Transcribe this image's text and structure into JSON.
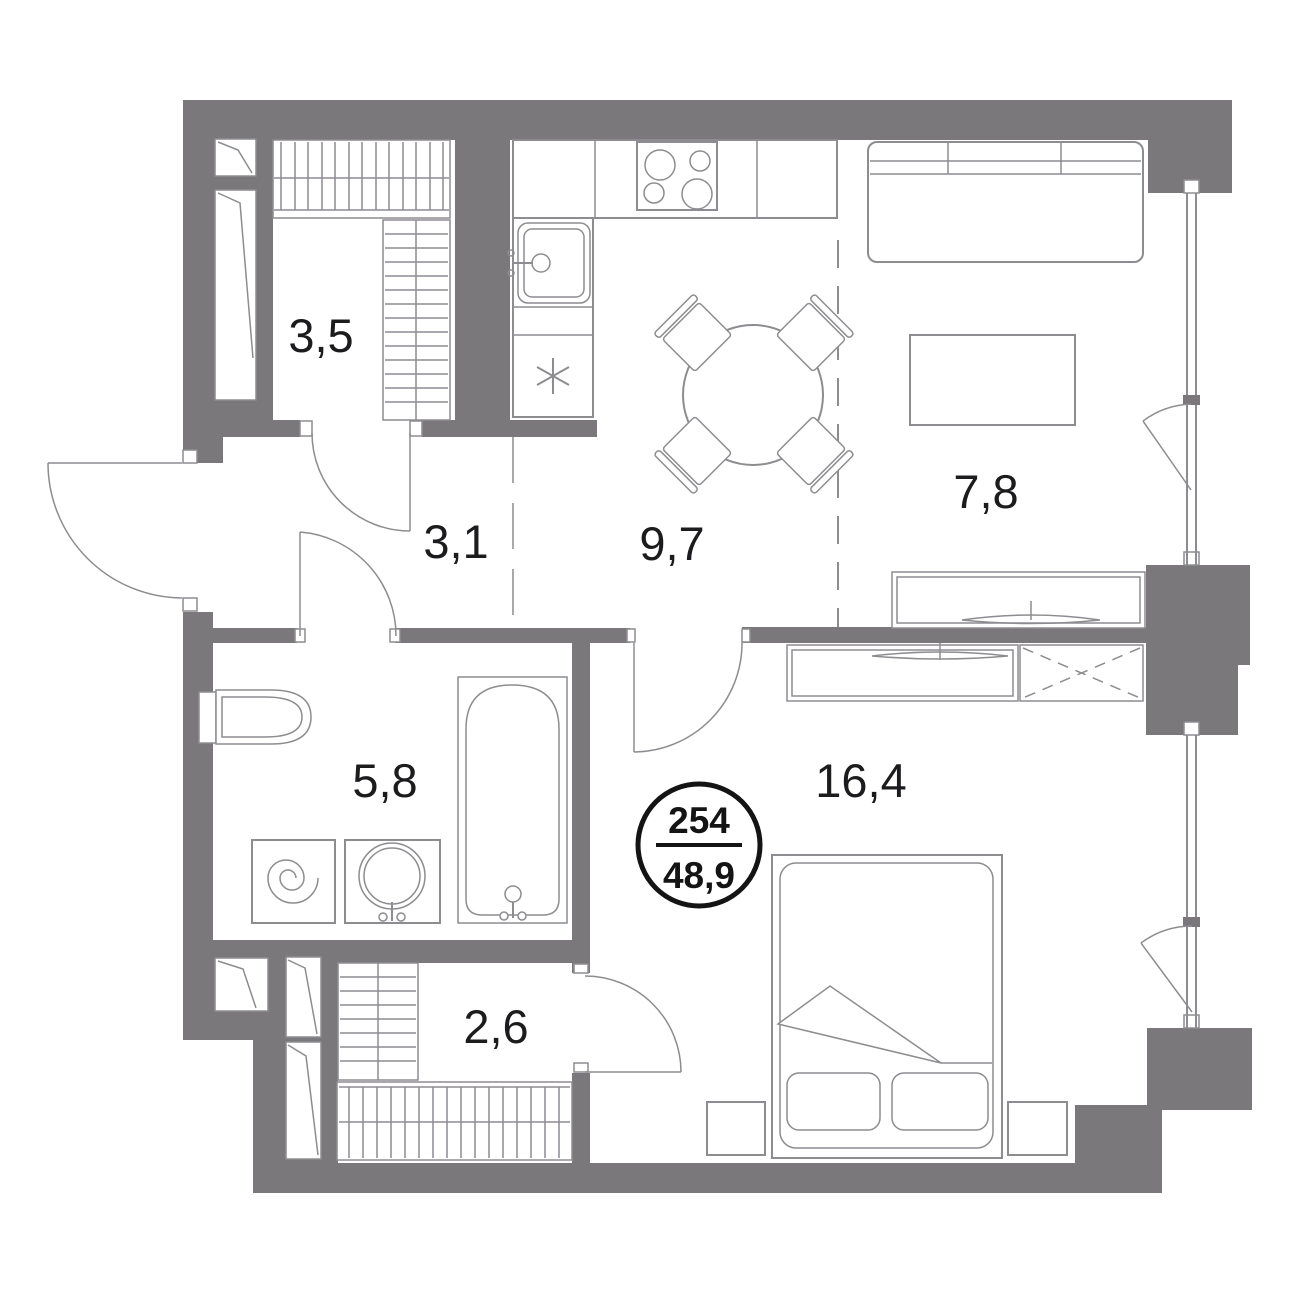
{
  "plan": {
    "badge": {
      "unit_number": "254",
      "total_area": "48,9"
    },
    "rooms": [
      {
        "name": "storage",
        "label": "3,5"
      },
      {
        "name": "hallway",
        "label": "3,1"
      },
      {
        "name": "kitchen-dining",
        "label": "9,7"
      },
      {
        "name": "living-area",
        "label": "7,8"
      },
      {
        "name": "bathroom",
        "label": "5,8"
      },
      {
        "name": "bedroom",
        "label": "16,4"
      },
      {
        "name": "closet",
        "label": "2,6"
      }
    ],
    "symbols": {
      "appliance_marker": "asterisk"
    },
    "colors": {
      "wall": "#7a787b",
      "line": "#8d8c90",
      "text": "#1c1c1e",
      "badge": "#141414",
      "bg": "#ffffff"
    }
  }
}
